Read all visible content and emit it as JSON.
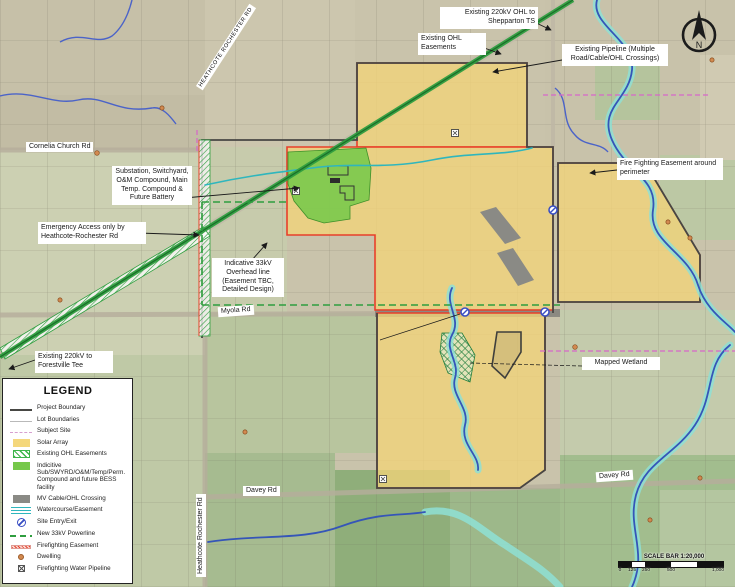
{
  "annotations": {
    "shepparton": "Existing 220kV OHL to Shepparton TS",
    "ohl_easements": "Existing OHL Easements",
    "pipeline": "Existing Pipeline (Multiple Road/Cable/OHL Crossings)",
    "fire_easement": "Fire Fighting Easement around perimeter",
    "substation": "Substation, Switchyard, O&M Compound, Main Temp. Compound & Future Battery",
    "emergency": "Emergency Access only by Heathcote-Rochester Rd",
    "indicative_33kv": "Indicative 33kV Overhead line (Easement TBC, Detailed Design)",
    "forestville": "Existing 220kV to Forestville Tee",
    "wetland": "Mapped Wetland"
  },
  "roads": {
    "cornelia": "Cornelia Church Rd",
    "myola": "Myola Rd",
    "davey_west": "Davey Rd",
    "davey_east": "Davey Rd",
    "heathcote_vertical": "Heathcote Rochester Rd",
    "heathcote_diagonal": "HEATHCOTE ROCHESTER RD"
  },
  "legend": {
    "title": "LEGEND",
    "items": [
      {
        "label": "Project Boundary",
        "swatch": "project-boundary"
      },
      {
        "label": "Lot Boundaries",
        "swatch": "lot-boundaries"
      },
      {
        "label": "Subject Site",
        "swatch": "subject-site"
      },
      {
        "label": "Solar Array",
        "swatch": "solar-array"
      },
      {
        "label": "Existing OHL Easements",
        "swatch": "ohl-easements"
      },
      {
        "label": "Indicitive Sub/SWYRD/O&M/Temp/Perm. Compound and future BESS facility",
        "swatch": "compound"
      },
      {
        "label": "MV Cable/OHL Crossing",
        "swatch": "mv-cable"
      },
      {
        "label": "Watercourse/Easement",
        "swatch": "watercourse"
      },
      {
        "label": "Site Entry/Exit",
        "swatch": "site-entry"
      },
      {
        "label": "New 33kV Powerline",
        "swatch": "new-33kv"
      },
      {
        "label": "Firefighting Easement",
        "swatch": "firefighting-easement"
      },
      {
        "label": "Dwelling",
        "swatch": "dwelling"
      },
      {
        "label": "Firefighting Water Pipeline",
        "swatch": "firefighting-water-pipeline"
      }
    ]
  },
  "scale_bar": {
    "label": "SCALE BAR 1:20,000",
    "ticks": [
      "0",
      "125",
      "250",
      "500",
      "1,000"
    ]
  },
  "compass": {
    "label": "N"
  },
  "colors": {
    "solar_array": "#f2d478",
    "ohl_line": "#2f9e3f",
    "compound": "#76c84a",
    "firefighting": "#e8402a",
    "watercourse": "#2fb6bd",
    "project_boundary": "#474744",
    "subject_site": "#d667c9",
    "mv_cable": "#8a8a85",
    "site_entry": "#3a4fc4",
    "dwelling": "#d28a50"
  }
}
